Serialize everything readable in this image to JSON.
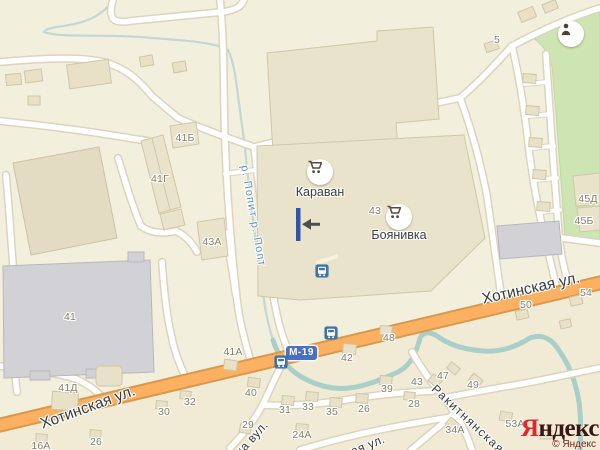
{
  "map": {
    "streets": [
      {
        "label": "Хотинская ул.",
        "x": 88,
        "y": 408,
        "rotate": -20,
        "size": 15.5
      },
      {
        "label": "Хотинская ул.",
        "x": 531,
        "y": 289,
        "rotate": -12.5,
        "size": 15.5
      },
      {
        "label": "Ракитнянская",
        "x": 468,
        "y": 419,
        "rotate": 43,
        "size": 12,
        "spacing": 1.5
      },
      {
        "label": "ка вул.",
        "x": 252,
        "y": 438,
        "rotate": -48,
        "size": 12,
        "spacing": 0.5
      },
      {
        "label": "ая ул.",
        "x": 368,
        "y": 445,
        "rotate": -22,
        "size": 12,
        "spacing": 0.5
      }
    ],
    "river_label": {
      "label": "р. Попит р. Попт"
    },
    "road_badge": {
      "label": "М-19"
    },
    "pois": [
      {
        "type": "shop",
        "label": "Караван"
      },
      {
        "type": "shop",
        "label": "Боянивка"
      },
      {
        "type": "monument",
        "label": ""
      }
    ],
    "bus_stops": [
      {
        "x": 322,
        "y": 271
      },
      {
        "x": 331,
        "y": 333
      },
      {
        "x": 281,
        "y": 362
      }
    ],
    "house_numbers": [
      {
        "n": "5",
        "x": 497,
        "y": 40
      },
      {
        "n": "41Б",
        "x": 185,
        "y": 138
      },
      {
        "n": "41Г",
        "x": 160,
        "y": 179
      },
      {
        "n": "43А",
        "x": 212,
        "y": 242
      },
      {
        "n": "41",
        "x": 70,
        "y": 317
      },
      {
        "n": "41Д",
        "x": 68,
        "y": 388
      },
      {
        "n": "41А",
        "x": 233,
        "y": 352
      },
      {
        "n": "40",
        "x": 251,
        "y": 393
      },
      {
        "n": "31",
        "x": 285,
        "y": 410
      },
      {
        "n": "33",
        "x": 308,
        "y": 407
      },
      {
        "n": "35",
        "x": 332,
        "y": 412
      },
      {
        "n": "26",
        "x": 364,
        "y": 409
      },
      {
        "n": "29",
        "x": 248,
        "y": 425
      },
      {
        "n": "24А",
        "x": 302,
        "y": 435
      },
      {
        "n": "42",
        "x": 347,
        "y": 358
      },
      {
        "n": "48",
        "x": 389,
        "y": 338
      },
      {
        "n": "39",
        "x": 387,
        "y": 389
      },
      {
        "n": "50",
        "x": 526,
        "y": 305
      },
      {
        "n": "54",
        "x": 586,
        "y": 293
      },
      {
        "n": "32",
        "x": 190,
        "y": 402
      },
      {
        "n": "30",
        "x": 164,
        "y": 412
      },
      {
        "n": "26",
        "x": 96,
        "y": 442
      },
      {
        "n": "16А",
        "x": 41,
        "y": 446
      },
      {
        "n": "28",
        "x": 414,
        "y": 404
      },
      {
        "n": "43",
        "x": 417,
        "y": 382
      },
      {
        "n": "49",
        "x": 473,
        "y": 385
      },
      {
        "n": "47",
        "x": 443,
        "y": 376
      },
      {
        "n": "34А",
        "x": 455,
        "y": 430
      },
      {
        "n": "53А",
        "x": 515,
        "y": 424
      },
      {
        "n": "43",
        "x": 375,
        "y": 211
      },
      {
        "n": "45Д",
        "x": 588,
        "y": 199
      },
      {
        "n": "45Б",
        "x": 584,
        "y": 221
      }
    ],
    "attribution": {
      "brand_first": "Я",
      "brand_rest": "ндекс",
      "copyright": "© Яндекс"
    },
    "colors": {
      "land": "#F3EFDD",
      "park_green": "#CDE4B3",
      "river": "#A9CFC8",
      "road_orange": "#FCB062",
      "road_casing": "#D8994C",
      "bus_blue": "#3E74A8",
      "badge_blue": "#4A70C4",
      "building_beige": "#EAE3CB",
      "building_gray": "#D2D2D6",
      "logo_red": "#E6262B"
    }
  }
}
